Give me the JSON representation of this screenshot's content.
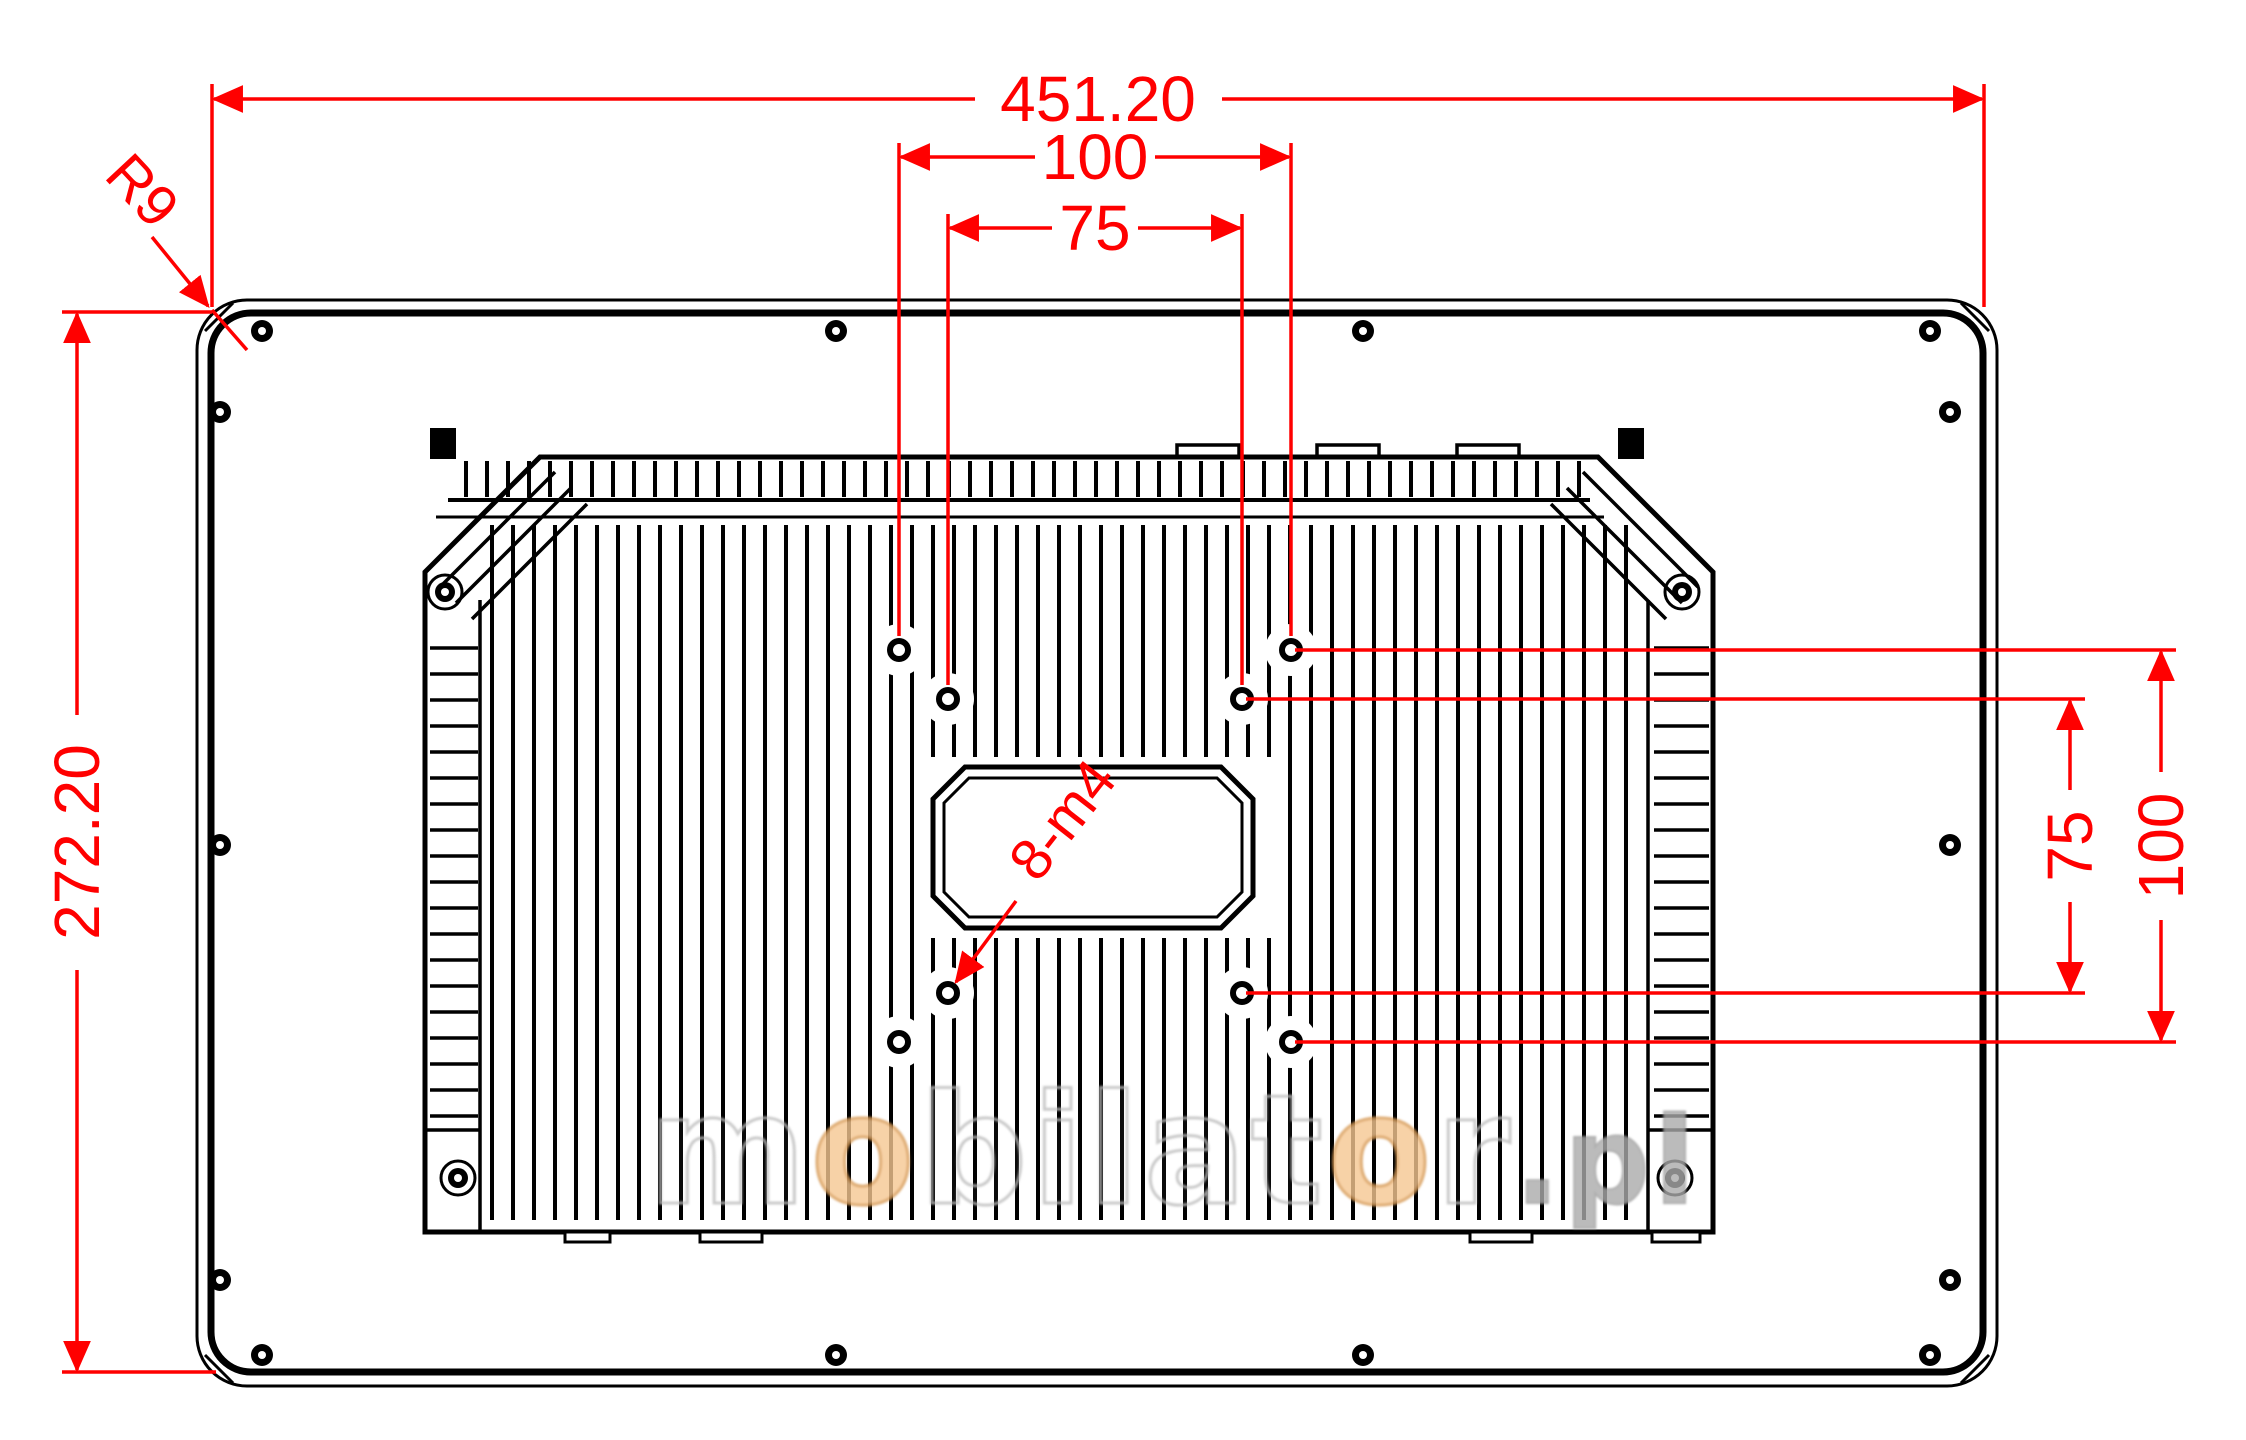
{
  "drawing": {
    "description": "Technical rear-view dimension drawing of an industrial panel PC with VESA mount holes",
    "colors": {
      "background": "#ffffff",
      "outline_black": "#000000",
      "dimension_red": "#ff0000",
      "watermark_gray": "#bdbdbd",
      "watermark_orange": "#f6c792"
    },
    "labels": {
      "overall_width": "451.20",
      "vesa100_top": "100",
      "vesa75_top": "75",
      "overall_height": "272.20",
      "vesa75_right": "75",
      "vesa100_right": "100",
      "corner_radius": "R9",
      "mount_holes": "8-m4"
    },
    "watermark": {
      "m": "m",
      "o1": "o",
      "mid": "bilat",
      "o2": "o",
      "r": "r",
      "tld": ".pl"
    }
  }
}
